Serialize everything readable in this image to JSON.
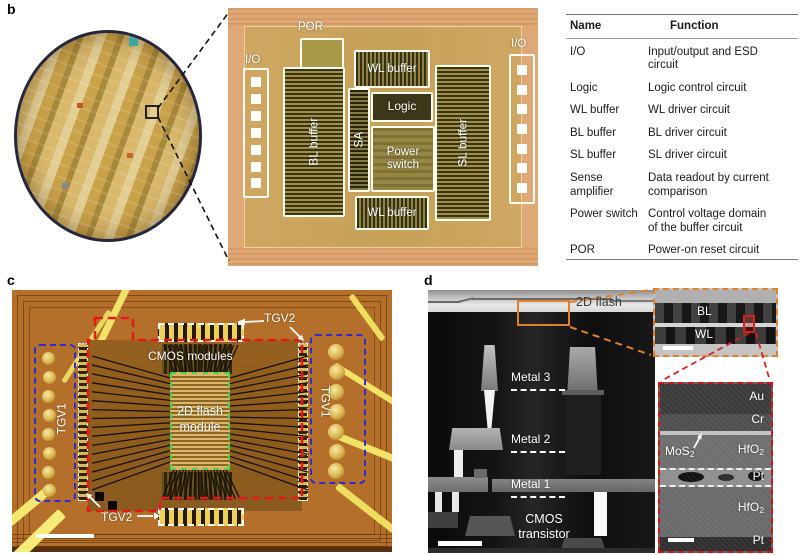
{
  "figure": {
    "panel_b": {
      "letter": "b",
      "die": {
        "por": "POR",
        "io_left": "I/O",
        "io_right": "I/O",
        "bl_buffer": "BL buffer",
        "sa": "SA",
        "wl_buffer_top": "WL buffer",
        "logic": "Logic",
        "power_switch": "Power switch",
        "wl_buffer_bottom": "WL buffer",
        "sl_buffer": "SL buffer"
      },
      "table": {
        "header": {
          "name": "Name",
          "function": "Function"
        },
        "rows": [
          {
            "name": "I/O",
            "function": "Input/output and ESD circuit"
          },
          {
            "name": "Logic",
            "function": "Logic control circuit"
          },
          {
            "name": "WL buffer",
            "function": "WL driver circuit"
          },
          {
            "name": "BL buffer",
            "function": "BL driver circuit"
          },
          {
            "name": "SL buffer",
            "function": "SL driver circuit"
          },
          {
            "name": "Sense amplifier",
            "function": "Data readout by current comparison"
          },
          {
            "name": "Power switch",
            "function": "Control voltage domain of the buffer circuit"
          },
          {
            "name": "POR",
            "function": "Power-on reset circuit"
          }
        ]
      }
    },
    "panel_c": {
      "letter": "c",
      "labels": {
        "tgv2_top": "TGV2",
        "tgv2_bottom": "TGV2",
        "tgv1_left": "TGV1",
        "tgv1_right": "TGV1",
        "cmos_modules": "CMOS modules",
        "flash_line1": "2D flash",
        "flash_line2": "module"
      }
    },
    "panel_d": {
      "letter": "d",
      "labels": {
        "flash": "2D flash",
        "metal3": "Metal 3",
        "metal2": "Metal 2",
        "metal1": "Metal 1",
        "cmos_line1": "CMOS",
        "cmos_line2": "transistor",
        "bl": "BL",
        "wl": "WL",
        "au": "Au",
        "cr": "Cr",
        "pt_mid": "Pt",
        "pt_bottom": "Pt",
        "mos2": {
          "base": "MoS",
          "sub": "2"
        },
        "hfo2_upper": {
          "base": "HfO",
          "sub": "2"
        },
        "hfo2_lower": {
          "base": "HfO",
          "sub": "2"
        }
      }
    },
    "annotation_colors": {
      "red": "#e01818",
      "blue": "#2c2cd6",
      "green": "#46d24c",
      "orange": "#e08028",
      "white": "#ffffff"
    }
  }
}
